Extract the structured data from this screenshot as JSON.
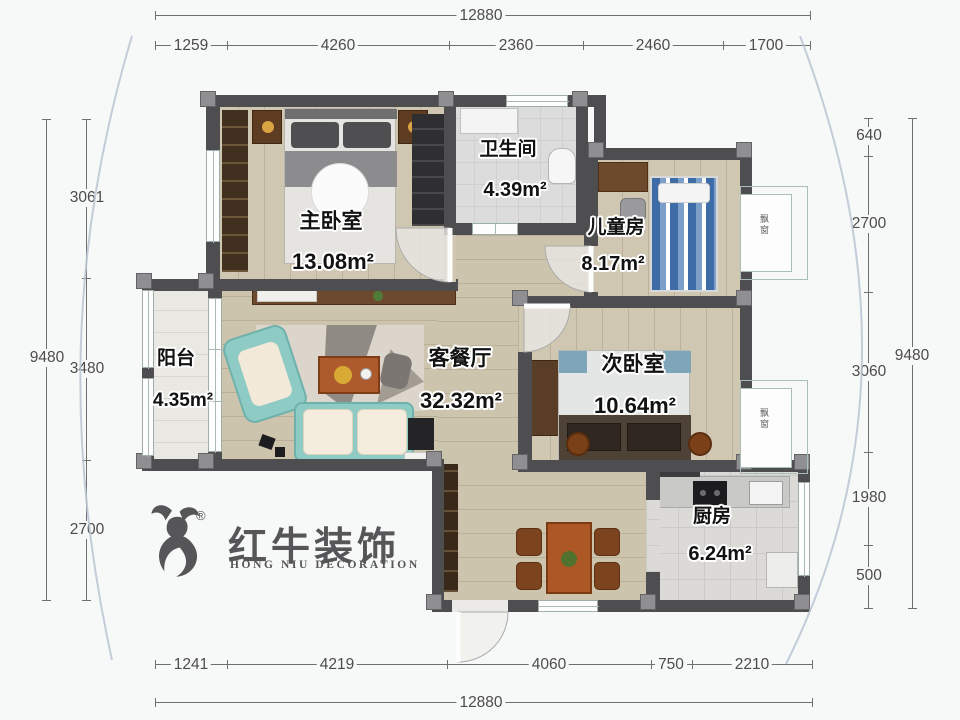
{
  "rooms": {
    "master": {
      "name": "主卧室",
      "area": "13.08m²"
    },
    "bathroom": {
      "name": "卫生间",
      "area": "4.39m²"
    },
    "kids": {
      "name": "儿童房",
      "area": "8.17m²"
    },
    "living": {
      "name": "客餐厅",
      "area": "32.32m²"
    },
    "second": {
      "name": "次卧室",
      "area": "10.64m²"
    },
    "balcony": {
      "name": "阳台",
      "area": "4.35m²"
    },
    "kitchen": {
      "name": "厨房",
      "area": "6.24m²"
    }
  },
  "bay_windows": [
    "飘窗",
    "飘窗"
  ],
  "dimensions": {
    "top_total": "12880",
    "bottom_total": "12880",
    "top_segments": [
      "1259",
      "4260",
      "2360",
      "2460",
      "1700"
    ],
    "bottom_segments": [
      "1241",
      "4219",
      "4060",
      "750",
      "2210"
    ],
    "left_outer": "9480",
    "left_segments": [
      "3061",
      "3480",
      "2700"
    ],
    "right_outer": "9480",
    "right_segments": [
      "640",
      "2700",
      "3060",
      "1980",
      "500"
    ]
  },
  "logo": {
    "cn": "红牛装饰",
    "en": "HONG NIU DECORATION",
    "reg": "®"
  },
  "colors": {
    "wall": "#4e4e50",
    "wood_floor": "#d0c7b2",
    "tile_floor": "#dcdcdc",
    "sofa_teal": "#8ecbc5",
    "cushion_cream": "#f4ecdc",
    "table_orange": "#ad5626",
    "kids_bed_blue": "#3e6ca6",
    "dim_text": "#4c4c4c",
    "curve_blue": "#b8c6d3"
  }
}
